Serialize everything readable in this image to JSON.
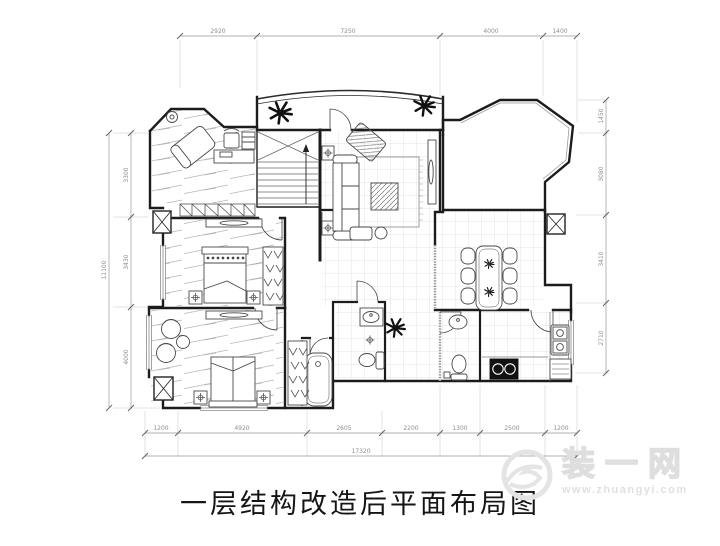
{
  "title": "一层结构改造后平面布局图",
  "watermark": {
    "brand": "装一网",
    "url": "www.zhuangyi.com"
  },
  "dims": {
    "top": [
      "2920",
      "7250",
      "4000",
      "1400"
    ],
    "bottom": [
      "1200",
      "4920",
      "2605",
      "2200",
      "1300",
      "2500",
      "1200"
    ],
    "bottom_total": "17320",
    "left": [
      "3300",
      "3430",
      "4000"
    ],
    "left_total": "11100",
    "right": [
      "1450",
      "3080",
      "3410",
      "2710"
    ]
  },
  "colors": {
    "wall": "#1c1c1c",
    "furniture": "#4a4a4a",
    "dim_text": "#8f8f8f",
    "tile": "#cccccc",
    "watermark": "#e0e0e0"
  }
}
